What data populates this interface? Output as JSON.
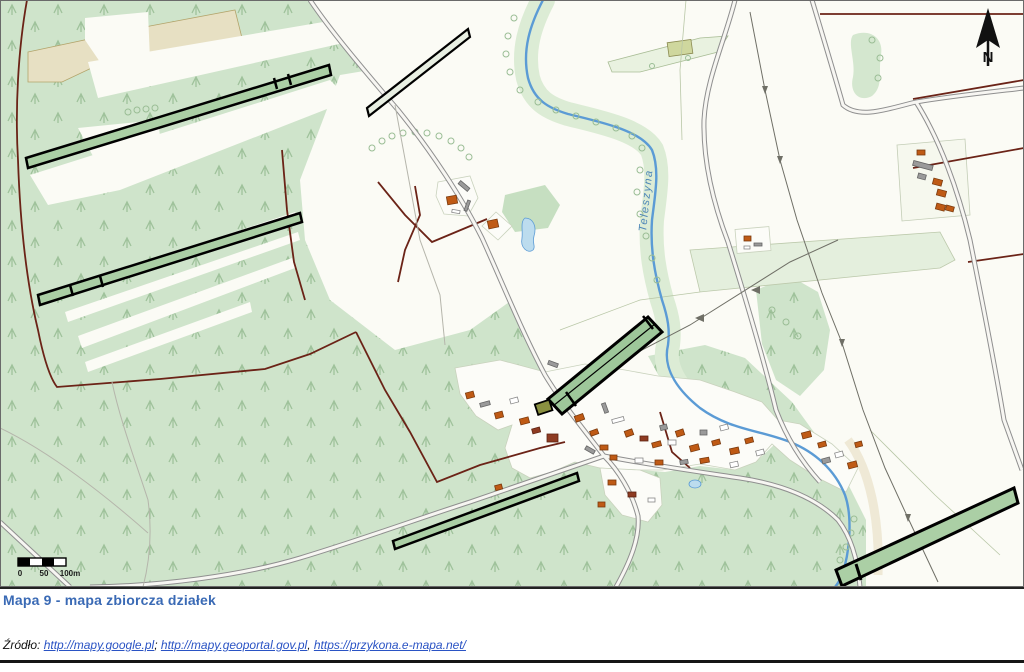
{
  "map": {
    "labels": {
      "stream": "Teleszyna"
    },
    "compass": {
      "label": "N"
    },
    "scalebar": {
      "tick_zero": "0",
      "tick_mid": "50",
      "tick_end": "100m"
    },
    "colors": {
      "forest_green": "#cfe4cb",
      "tree_symbol_green": "#9fc29b",
      "highlighted_plot_fill": "#abcfa5",
      "highlighted_plot_outline": "#000000",
      "water_blue": "#5b9bd5",
      "pond_fill": "#bcdcee",
      "road_casing_gray": "#8f8f8f",
      "boundary_maroon": "#6b2317",
      "sand_tan": "#e7e0c3",
      "building_orange": "#bf5a15",
      "building_darkred": "#8e3b22",
      "building_gray": "#9a9a9a",
      "caption_blue": "#3a6ab5",
      "link_blue": "#2a53c4"
    }
  },
  "caption": {
    "title": "Mapa 9 - mapa zbiorcza działek"
  },
  "source": {
    "prefix": "Źródło:",
    "link_google": "http://mapy.google.pl",
    "sep1": "; ",
    "link_geoportal": "http://mapy.geoportal.gov.pl",
    "sep2": ", ",
    "link_emapa": "https://przykona.e-mapa.net/"
  }
}
